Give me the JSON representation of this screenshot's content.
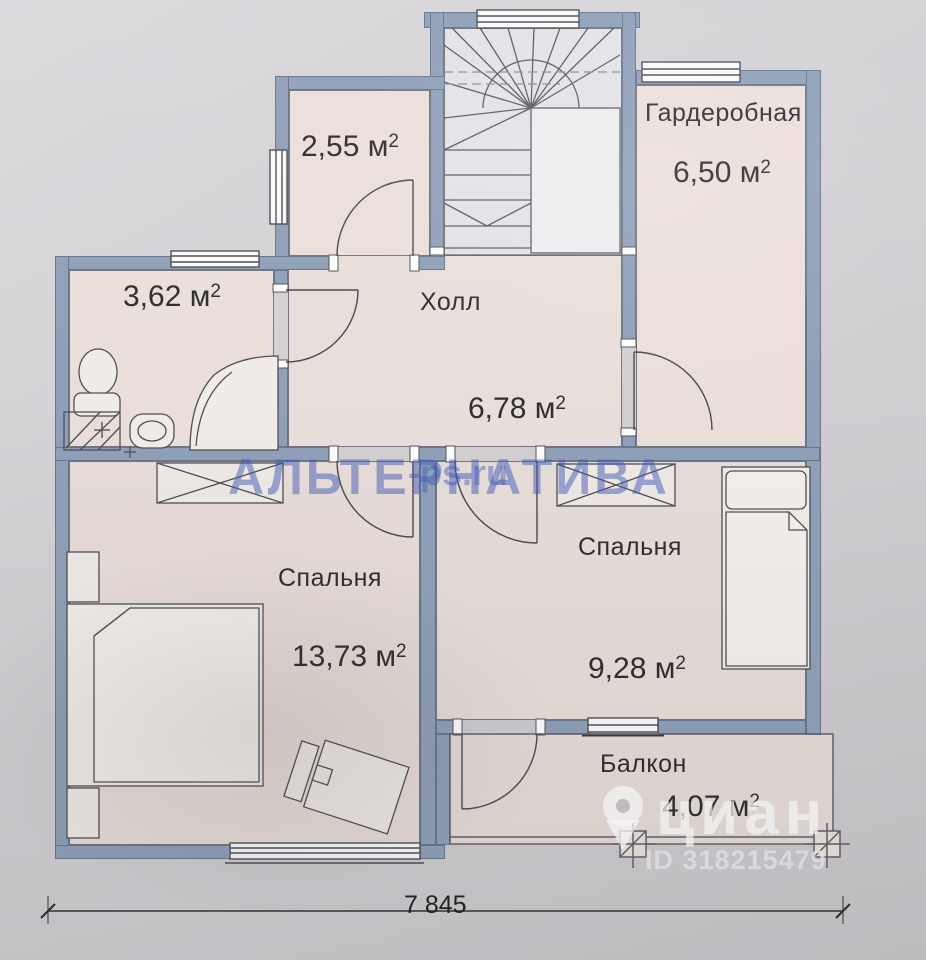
{
  "rooms": {
    "closet": {
      "area_value": "2,55",
      "area_unit": "м",
      "area_sup": "2"
    },
    "bathroom": {
      "area_value": "3,62",
      "area_unit": "м",
      "area_sup": "2"
    },
    "hall": {
      "name": "Холл",
      "area_value": "6,78",
      "area_unit": "м",
      "area_sup": "2"
    },
    "wardrobe": {
      "name": "Гардеробная",
      "area_value": "6,50",
      "area_unit": "м",
      "area_sup": "2"
    },
    "bedroom_left": {
      "name": "Спальня",
      "area_value": "13,73",
      "area_unit": "м",
      "area_sup": "2"
    },
    "bedroom_right": {
      "name": "Спальня",
      "area_value": "9,28",
      "area_unit": "м",
      "area_sup": "2"
    },
    "balcony": {
      "name": "Балкон",
      "area_value": "4,07",
      "area_unit": "м",
      "area_sup": "2"
    }
  },
  "dimension": {
    "bottom_width": "7 845"
  },
  "watermarks": {
    "agency": "АЛЬТЕРНАТИВА",
    "site_fragment": "-ps.ru",
    "portal": "циан",
    "listing_id": "ID 318215479"
  },
  "colors": {
    "wall": "#8fa0b8",
    "room_fill": "#eadfd9",
    "stair_fill": "#e3e2e6",
    "paper": "#d2d0d3",
    "watermark_blue": "#405cb8"
  }
}
